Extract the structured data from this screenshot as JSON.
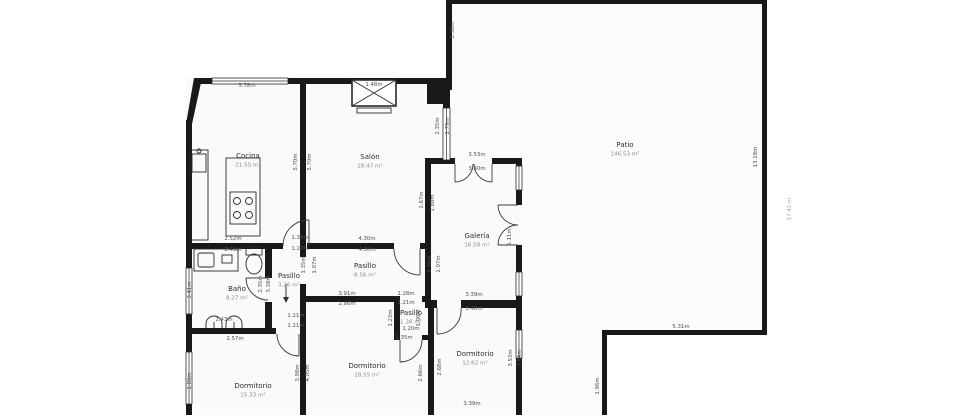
{
  "colors": {
    "background": "#ffffff",
    "wall": "#191919",
    "floor": "#fafafa",
    "dimension_text": "#4f4f4f",
    "room_name_text": "#2d2d2d",
    "room_area_text": "#8c8c8c"
  },
  "rooms": [
    {
      "name": "Cocina",
      "area": "21.55 m²",
      "x": 248,
      "y": 158
    },
    {
      "name": "Salón",
      "area": "28.47 m²",
      "x": 370,
      "y": 159
    },
    {
      "name": "Galería",
      "area": "16.58 m²",
      "x": 477,
      "y": 238
    },
    {
      "name": "Pasillo",
      "area": "8.56 m²",
      "x": 365,
      "y": 268
    },
    {
      "name": "Pasillo",
      "area": "3.26 m²",
      "x": 289,
      "y": 278
    },
    {
      "name": "Pasillo",
      "area": "1.38 m²",
      "x": 411,
      "y": 315
    },
    {
      "name": "Baño",
      "area": "8.27 m²",
      "x": 237,
      "y": 291
    },
    {
      "name": "Dormitorio",
      "area": "15.33 m²",
      "x": 253,
      "y": 388
    },
    {
      "name": "Dormitorio",
      "area": "18.55 m²",
      "x": 367,
      "y": 368
    },
    {
      "name": "Dormitorio",
      "area": "12.62 m²",
      "x": 475,
      "y": 356
    },
    {
      "name": "Patio",
      "area": "146.53 m²",
      "x": 625,
      "y": 147
    }
  ],
  "dimensions": [
    {
      "t": "3.78m",
      "x": 247,
      "y": 87,
      "r": 0
    },
    {
      "t": "1.48m",
      "x": 374,
      "y": 86,
      "r": 0
    },
    {
      "t": "5.70m",
      "x": 297,
      "y": 162,
      "r": -90
    },
    {
      "t": "5.70m",
      "x": 311,
      "y": 162,
      "r": -90
    },
    {
      "t": "2.52m",
      "x": 233,
      "y": 240,
      "r": 0
    },
    {
      "t": "1.34m",
      "x": 300,
      "y": 239,
      "r": 0
    },
    {
      "t": "1.27m",
      "x": 300,
      "y": 250,
      "r": 0
    },
    {
      "t": "4.30m",
      "x": 367,
      "y": 240,
      "r": 0
    },
    {
      "t": "4.30m",
      "x": 367,
      "y": 251,
      "r": 0
    },
    {
      "t": "2.35m",
      "x": 439,
      "y": 126,
      "r": -90
    },
    {
      "t": "2.79m",
      "x": 449,
      "y": 126,
      "r": -90
    },
    {
      "t": "3.38m",
      "x": 454,
      "y": 30,
      "r": -90
    },
    {
      "t": "3.53m",
      "x": 477,
      "y": 156,
      "r": 0
    },
    {
      "t": "3.40m",
      "x": 477,
      "y": 170,
      "r": 0
    },
    {
      "t": "2.67m",
      "x": 423,
      "y": 200,
      "r": -90
    },
    {
      "t": "1.88m",
      "x": 434,
      "y": 203,
      "r": -90
    },
    {
      "t": "5.11m",
      "x": 511,
      "y": 237,
      "r": -90
    },
    {
      "t": "13.18m",
      "x": 757,
      "y": 157,
      "r": -90
    },
    {
      "t": "17.42 m",
      "x": 791,
      "y": 209,
      "r": -90,
      "light": true
    },
    {
      "t": "5.31m",
      "x": 681,
      "y": 328,
      "r": 0
    },
    {
      "t": "1.96m",
      "x": 599,
      "y": 386,
      "r": -90
    },
    {
      "t": "2.43m",
      "x": 233,
      "y": 251,
      "r": 0
    },
    {
      "t": "3.41m",
      "x": 191,
      "y": 290,
      "r": -90
    },
    {
      "t": "2.35m",
      "x": 262,
      "y": 284,
      "r": -90
    },
    {
      "t": "3.38m",
      "x": 270,
      "y": 284,
      "r": -90
    },
    {
      "t": "1.35m",
      "x": 305,
      "y": 265,
      "r": -90
    },
    {
      "t": "1.07m",
      "x": 316,
      "y": 265,
      "r": -90
    },
    {
      "t": "1.96m",
      "x": 431,
      "y": 264,
      "r": -90
    },
    {
      "t": "2.07m",
      "x": 440,
      "y": 264,
      "r": -90
    },
    {
      "t": "3.91m",
      "x": 347,
      "y": 295,
      "r": 0
    },
    {
      "t": "2.86m",
      "x": 347,
      "y": 305,
      "r": 0
    },
    {
      "t": "1.28m",
      "x": 406,
      "y": 295,
      "r": 0
    },
    {
      "t": "1.21m",
      "x": 406,
      "y": 304,
      "r": 0
    },
    {
      "t": "1.21m",
      "x": 296,
      "y": 317,
      "r": 0
    },
    {
      "t": "1.21m",
      "x": 296,
      "y": 327,
      "r": 0
    },
    {
      "t": "2.57m",
      "x": 235,
      "y": 340,
      "r": 0
    },
    {
      "t": "2.43m",
      "x": 224,
      "y": 321,
      "r": 0
    },
    {
      "t": "1.88m",
      "x": 191,
      "y": 381,
      "r": -90
    },
    {
      "t": "3.98m",
      "x": 299,
      "y": 373,
      "r": -90
    },
    {
      "t": "4.05m",
      "x": 309,
      "y": 373,
      "r": -90
    },
    {
      "t": "1.20m",
      "x": 411,
      "y": 330,
      "r": 0
    },
    {
      "t": "1.35m",
      "x": 404,
      "y": 339,
      "r": 0
    },
    {
      "t": "1.00m",
      "x": 420,
      "y": 318,
      "r": -90
    },
    {
      "t": "1.23m",
      "x": 392,
      "y": 318,
      "r": -90
    },
    {
      "t": "2.66m",
      "x": 422,
      "y": 373,
      "r": -90
    },
    {
      "t": "2.68m",
      "x": 441,
      "y": 367,
      "r": -90
    },
    {
      "t": "3.39m",
      "x": 474,
      "y": 296,
      "r": 0
    },
    {
      "t": "3.40m",
      "x": 474,
      "y": 310,
      "r": 0
    },
    {
      "t": "3.53m",
      "x": 512,
      "y": 358,
      "r": -90
    },
    {
      "t": "3.84m",
      "x": 521,
      "y": 358,
      "r": -90
    },
    {
      "t": "3.39m",
      "x": 472,
      "y": 405,
      "r": 0
    }
  ]
}
